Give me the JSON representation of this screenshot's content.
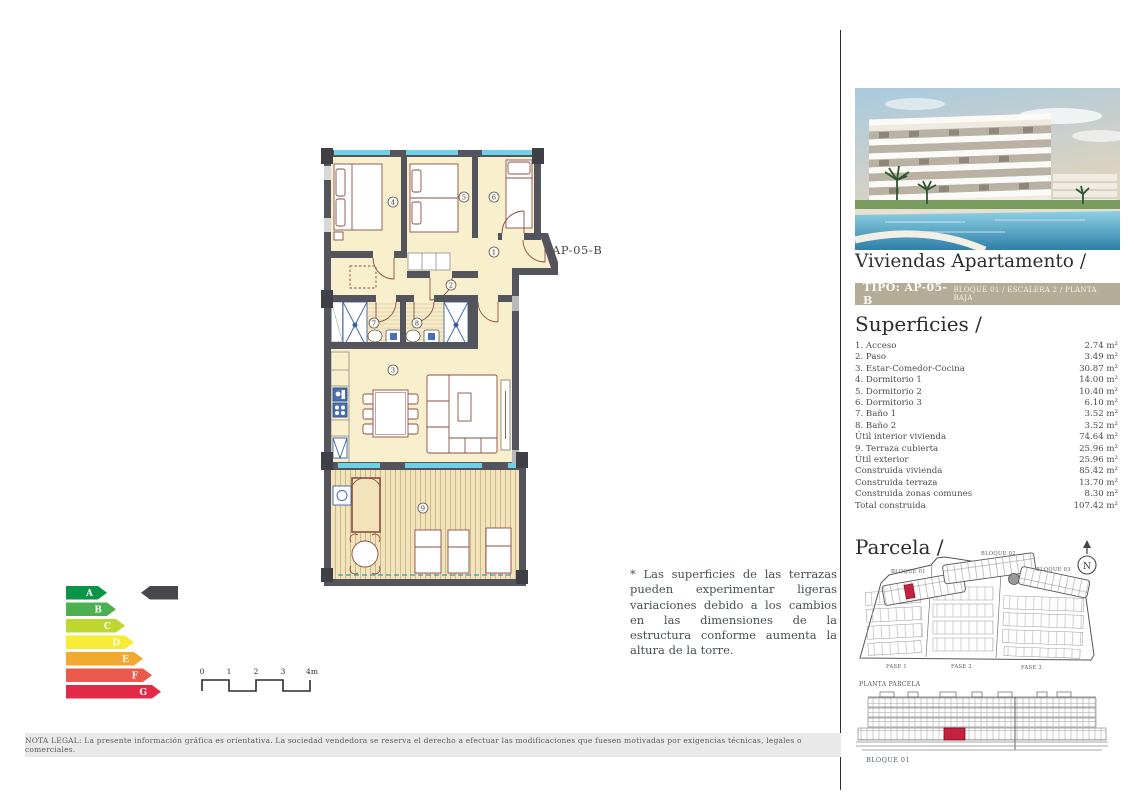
{
  "plan": {
    "unit_label": "AP-05-B",
    "room_numbers": [
      "1",
      "2",
      "3",
      "4",
      "5",
      "6",
      "7",
      "8",
      "9"
    ]
  },
  "note": {
    "text": "* Las superficies de las terrazas pueden experimentar ligeras variaciones debido a los cambios en las dimensiones de la estructura conforme aumenta la altura de la torre."
  },
  "sidebar": {
    "title": "Viviendas Apartamento /",
    "type_badge": {
      "left": "TIPO: AP-05-B",
      "right": "BLOQUE 01 / ESCALERA 2 / PLANTA BAJA"
    },
    "superficies": {
      "title": "Superficies /",
      "rows": [
        {
          "label": "1. Acceso",
          "value": "2.74 m²"
        },
        {
          "label": "2. Paso",
          "value": "3.49 m²"
        },
        {
          "label": "3. Estar-Comedor-Cocina",
          "value": "30.87 m²"
        },
        {
          "label": "4. Dormitorio 1",
          "value": "14.00 m²"
        },
        {
          "label": "5. Dormitorio 2",
          "value": "10.40 m²"
        },
        {
          "label": "6. Dormitorio 3",
          "value": "6.10 m²"
        },
        {
          "label": "7. Baño 1",
          "value": "3.52 m²"
        },
        {
          "label": "8. Baño 2",
          "value": "3.52 m²"
        },
        {
          "label": "Útil interior vivienda",
          "value": "74.64 m²"
        },
        {
          "label": "9. Terraza cubierta",
          "value": "25.96 m²"
        },
        {
          "label": "Útil exterior",
          "value": "25.96 m²"
        },
        {
          "label": "Construida vivienda",
          "value": "85.42 m²"
        },
        {
          "label": "Construida terraza",
          "value": "13.70 m²"
        },
        {
          "label": "Construida zonas comunes",
          "value": "8.30 m²"
        },
        {
          "label": "Total construida",
          "value": "107.42 m²"
        }
      ]
    },
    "parcela": {
      "title": "Parcela /",
      "labels": {
        "bloque1": "BLOQUE 01",
        "bloque2": "BLOQUE 02",
        "bloque3": "BLOQUE 03",
        "fase1": "FASE 1",
        "fase2": "FASE 2",
        "fase3": "FASE 3",
        "caption": "PLANTA PARCELA",
        "north": "N"
      }
    },
    "elevation": {
      "label": "BLOQUE 01"
    }
  },
  "energy": {
    "bars": [
      {
        "letter": "A",
        "color": "#0a9447"
      },
      {
        "letter": "B",
        "color": "#4cb050"
      },
      {
        "letter": "C",
        "color": "#bdd630"
      },
      {
        "letter": "D",
        "color": "#f7ec35"
      },
      {
        "letter": "E",
        "color": "#f2a932"
      },
      {
        "letter": "F",
        "color": "#e9594c"
      },
      {
        "letter": "G",
        "color": "#e12a47"
      }
    ],
    "pointer_color": "#47474d"
  },
  "scale_bar": {
    "labels": [
      "0",
      "1",
      "2",
      "3",
      "4m"
    ]
  },
  "legal": {
    "text": "NOTA LEGAL: La presente información gráfica es orientativa. La sociedad vendedora se reserva el derecho a efectuar las modificaciones que fuesen motivadas por exigencias técnicas, legales o comerciales."
  },
  "colors": {
    "accent_red": "#c22240",
    "badge_bg": "#b3ac97",
    "wall": "#54555c",
    "floor": "#f8efcd",
    "window": "#6fd1e7"
  }
}
